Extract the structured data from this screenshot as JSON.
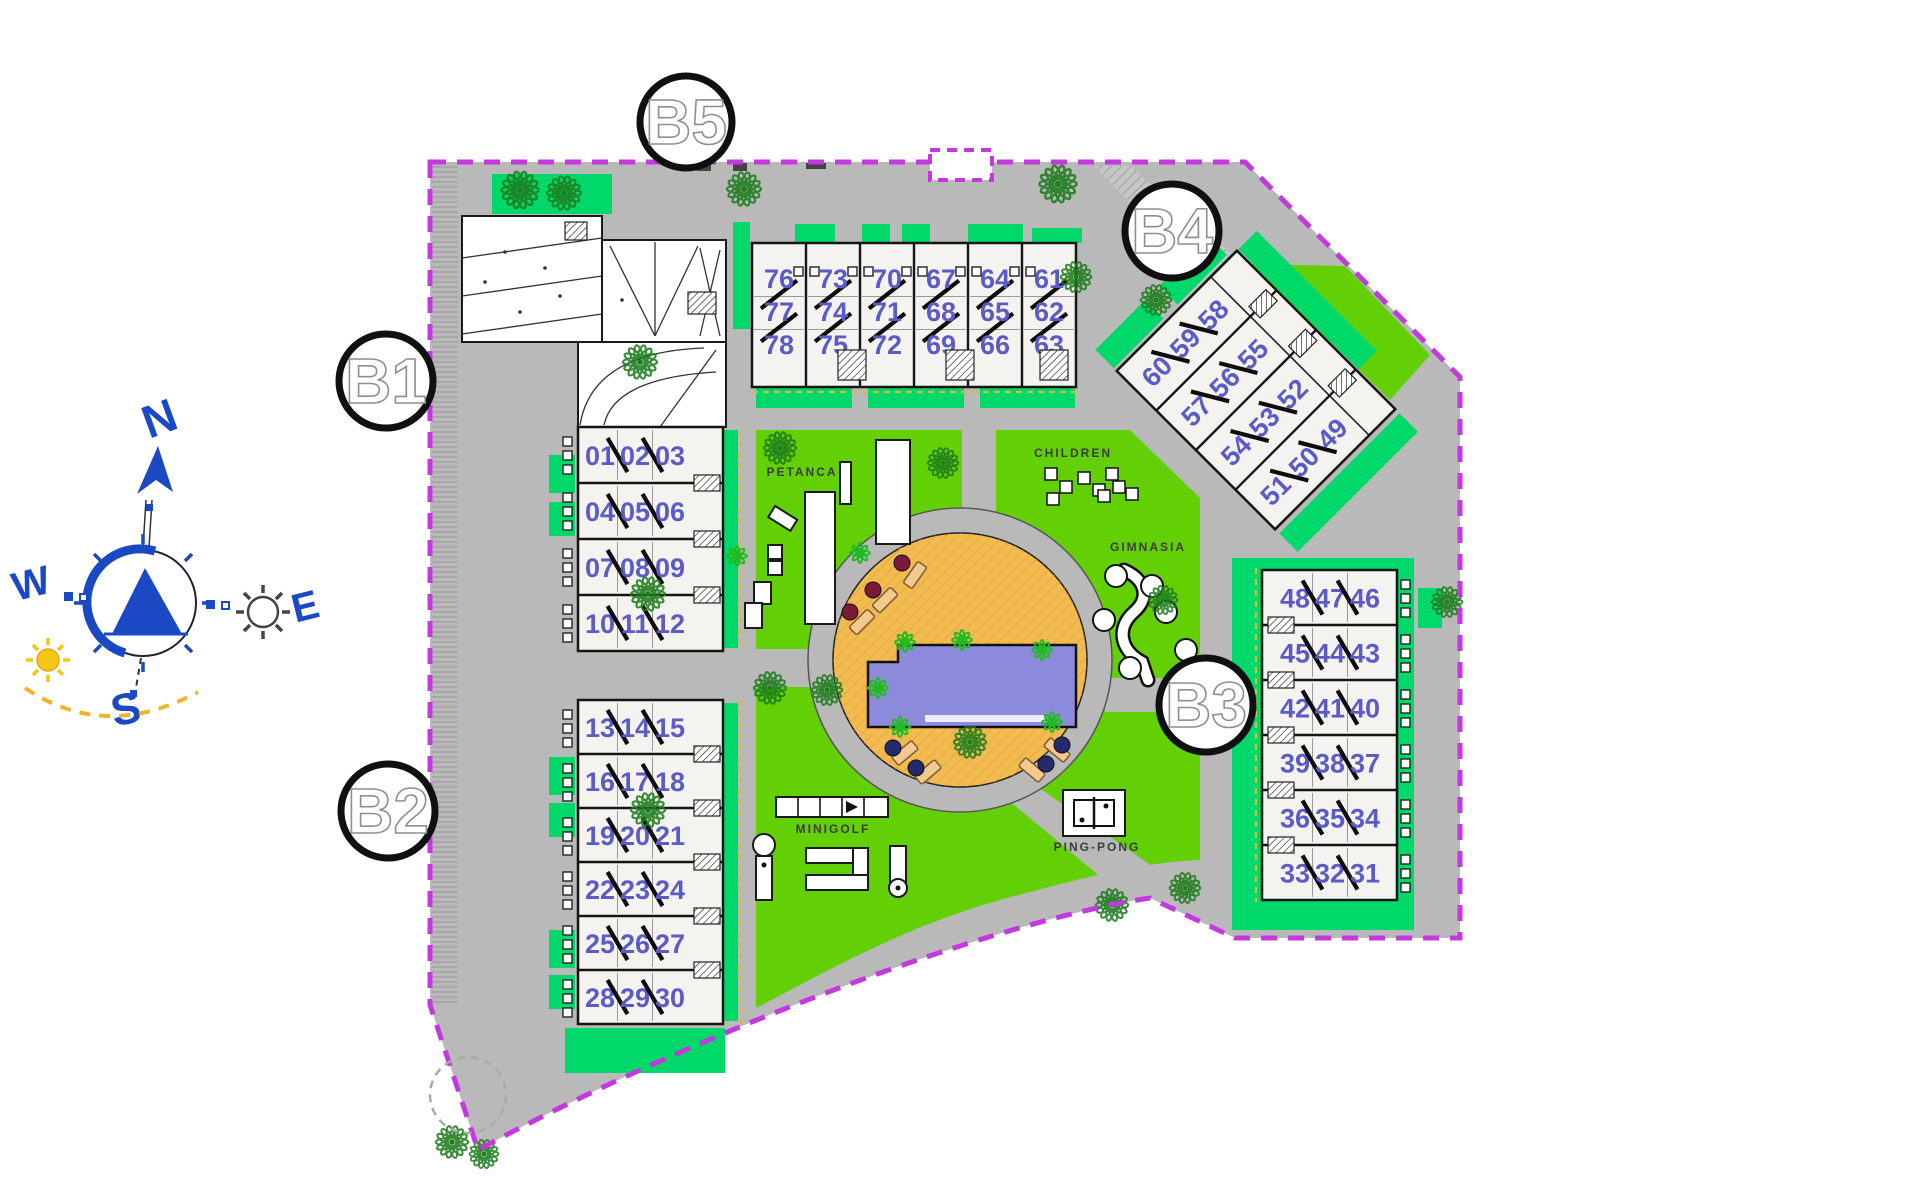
{
  "compass": {
    "north": "N",
    "south": "S",
    "east": "E",
    "west": "W"
  },
  "badges": {
    "b1": "B1",
    "b2": "B2",
    "b3": "B3",
    "b4": "B4",
    "b5": "B5"
  },
  "amenities": {
    "petanca": "PETANCA",
    "children": "CHILDREN",
    "gimnasia": "GIMNASIA",
    "minigolf": "MINIGOLF",
    "pingpong": "PING-PONG"
  },
  "buildings": {
    "b5": {
      "name": "Block B5",
      "unit_columns": [
        [
          "76",
          "77",
          "78"
        ],
        [
          "73",
          "74",
          "75"
        ],
        [
          "70",
          "71",
          "72"
        ],
        [
          "67",
          "68",
          "69"
        ],
        [
          "64",
          "65",
          "66"
        ],
        [
          "61",
          "62",
          "63"
        ]
      ]
    },
    "b4": {
      "name": "Block B4",
      "unit_rows": [
        [
          "60",
          "59",
          "58"
        ],
        [
          "57",
          "56",
          "55"
        ],
        [
          "54",
          "53",
          "52"
        ],
        [
          "51",
          "50",
          "49"
        ]
      ]
    },
    "b1": {
      "name": "Block B1",
      "unit_rows": [
        [
          "01",
          "02",
          "03"
        ],
        [
          "04",
          "05",
          "06"
        ],
        [
          "07",
          "08",
          "09"
        ],
        [
          "10",
          "11",
          "12"
        ]
      ]
    },
    "b2": {
      "name": "Block B2",
      "unit_rows": [
        [
          "13",
          "14",
          "15"
        ],
        [
          "16",
          "17",
          "18"
        ],
        [
          "19",
          "20",
          "21"
        ],
        [
          "22",
          "23",
          "24"
        ],
        [
          "25",
          "26",
          "27"
        ],
        [
          "28",
          "29",
          "30"
        ]
      ]
    },
    "b3": {
      "name": "Block B3",
      "unit_rows": [
        [
          "48",
          "47",
          "46"
        ],
        [
          "45",
          "44",
          "43"
        ],
        [
          "42",
          "41",
          "40"
        ],
        [
          "39",
          "38",
          "37"
        ],
        [
          "36",
          "35",
          "34"
        ],
        [
          "33",
          "32",
          "31"
        ]
      ]
    }
  },
  "colors": {
    "boundary": "#c438e0",
    "road": "#b9b9b9",
    "lawn": "#63cf05",
    "garden": "#00d96a",
    "deck": "#f3ba50",
    "pool": "#8d8cdc",
    "unit_number": "#5b5bc8",
    "compass_blue": "#1b49c4",
    "sun_yellow": "#f5c518",
    "tree": "#1e7d1e"
  }
}
